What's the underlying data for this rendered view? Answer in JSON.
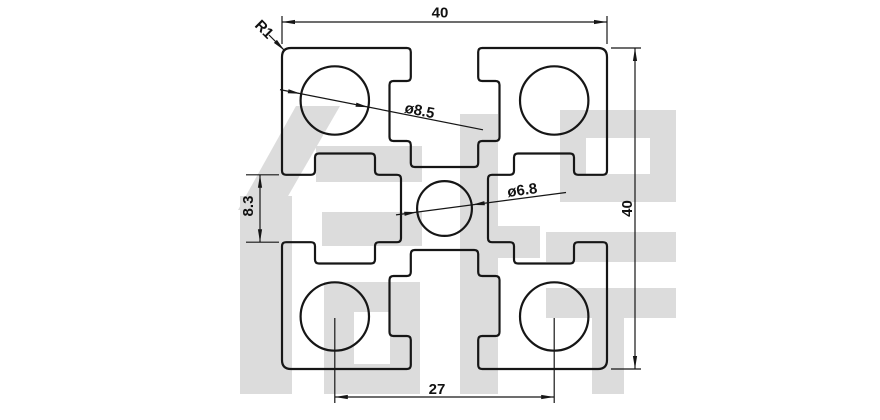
{
  "drawing": {
    "title": "aluminium-profile-4040-cross-section",
    "dimensions": {
      "width_top": "40",
      "height_right": "40",
      "slot_opening": "8.3",
      "hole_spacing": "27",
      "corner_radius": "R1",
      "corner_hole_dia": "ø8.5",
      "center_hole_dia": "ø6.8"
    },
    "watermark": "信牌",
    "colors": {
      "line": "#161616",
      "watermark": "#dcdcdc",
      "background": "#ffffff"
    }
  }
}
